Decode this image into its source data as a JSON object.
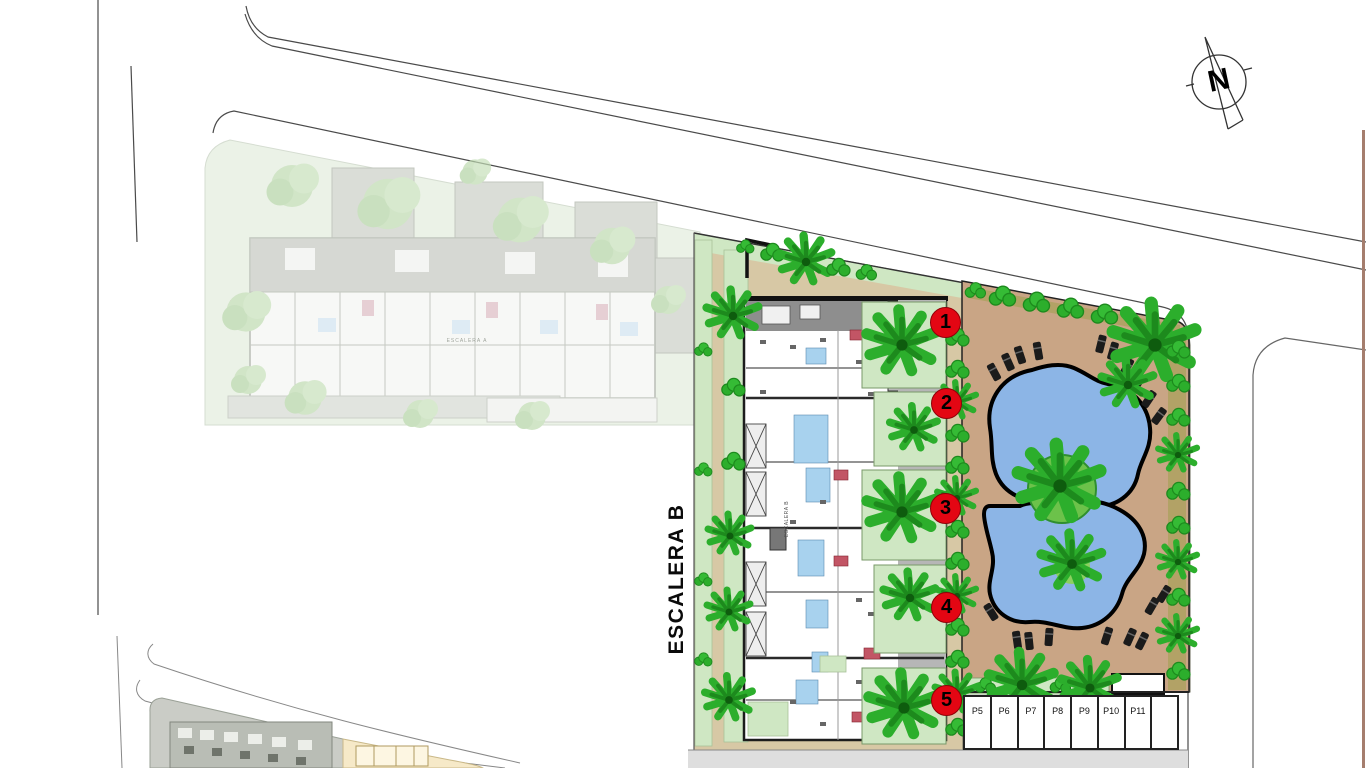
{
  "plan": {
    "large_label": "ESCALERA B",
    "building_b_inner_label": "ESCALERA B",
    "building_a_inner_label": "ESCALERA A",
    "compass": {
      "north_letter": "N"
    },
    "unit_markers": [
      {
        "number": "1",
        "x": 945,
        "y": 322
      },
      {
        "number": "2",
        "x": 946,
        "y": 403
      },
      {
        "number": "3",
        "x": 945,
        "y": 508
      },
      {
        "number": "4",
        "x": 946,
        "y": 607
      },
      {
        "number": "5",
        "x": 946,
        "y": 700
      }
    ],
    "parking": {
      "stalls": [
        "P5",
        "P6",
        "P7",
        "P8",
        "P9",
        "P10",
        "P11",
        ""
      ]
    },
    "colors": {
      "pool_water": "#8cb5e6",
      "deck_tan": "#c9a585",
      "path_tan": "#d7c8a5",
      "garden_green": "#cfe7c3",
      "tree_green": "#2cae2c",
      "marker_red": "#e30613",
      "olive_border": "#b2a266",
      "faded_site_green": "#e2ecdc"
    }
  }
}
